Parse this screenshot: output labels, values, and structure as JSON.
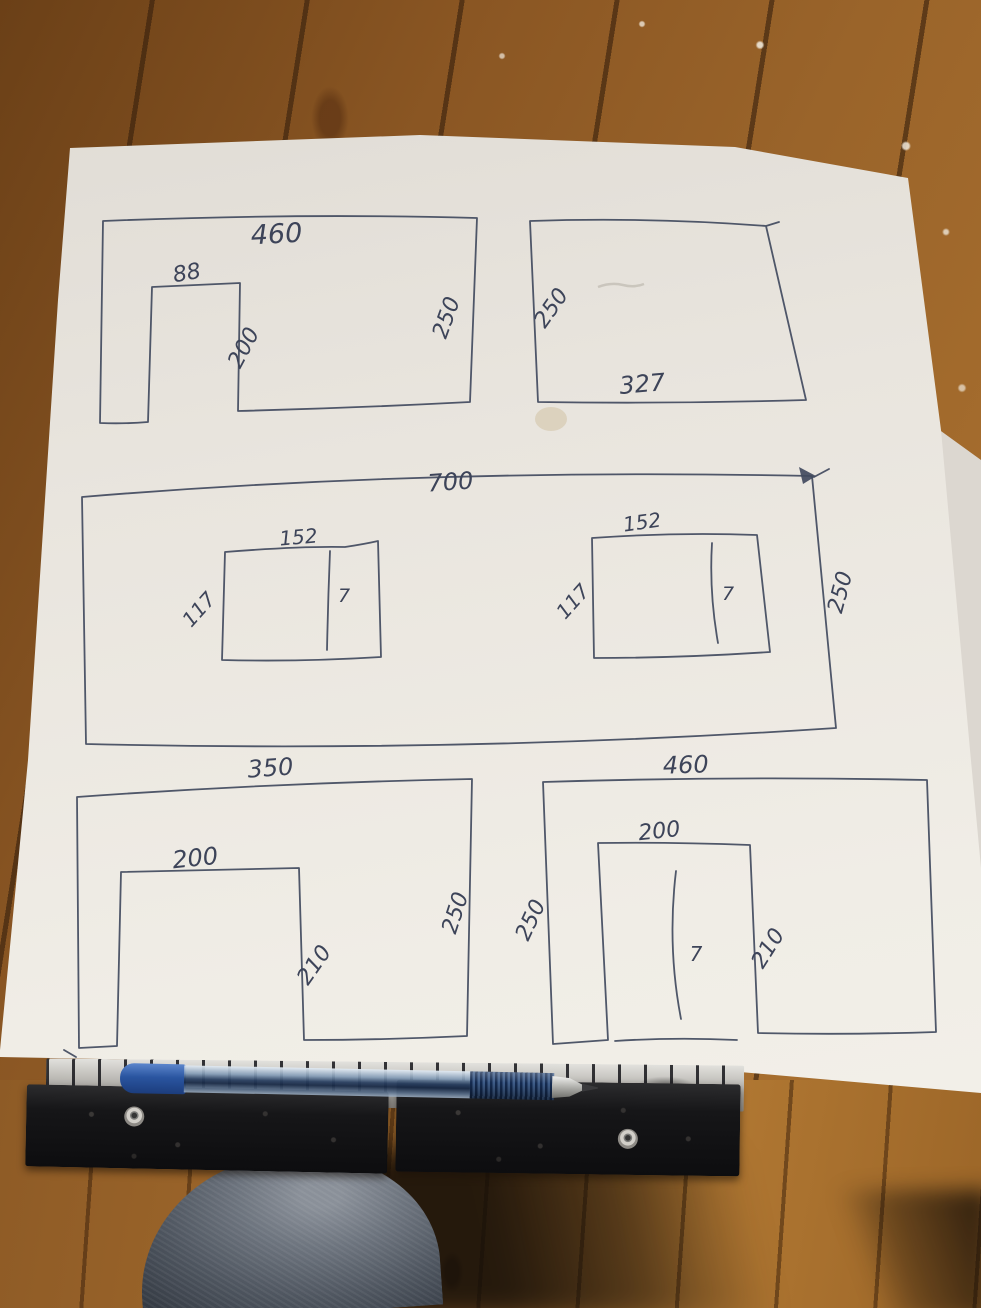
{
  "sketch": {
    "walls": [
      {
        "name": "top-left-wall",
        "width": "460",
        "height": "250",
        "opening": {
          "width": "88",
          "height": "200"
        }
      },
      {
        "name": "top-right-wall",
        "width": "327",
        "height": "250"
      },
      {
        "name": "middle-wall",
        "width": "700",
        "height": "250",
        "windows": [
          {
            "width": "152",
            "height": "117",
            "divider": "7"
          },
          {
            "width": "152",
            "height": "117",
            "divider": "7"
          }
        ]
      },
      {
        "name": "bottom-left-wall",
        "width": "350",
        "height": "250",
        "opening": {
          "width": "200",
          "height": "210"
        }
      },
      {
        "name": "bottom-right-wall",
        "width": "460",
        "height": "250",
        "opening": {
          "width": "200",
          "height": "210",
          "divider": "7"
        }
      }
    ]
  },
  "objects": {
    "pen": "blue-ballpoint-pen",
    "tool": "spirit-level-with-ruler-edge",
    "floor": "wooden-plank-floor",
    "leg": "denim-covered-knee",
    "extra_sheet": "second-paper-sheet"
  },
  "colors": {
    "paper": "#eae6e0",
    "ink": "#414a5e",
    "floor_wood": "#96622a",
    "pen_blue": "#2d55a0",
    "level_black": "#121214",
    "denim": "#4e555f"
  }
}
